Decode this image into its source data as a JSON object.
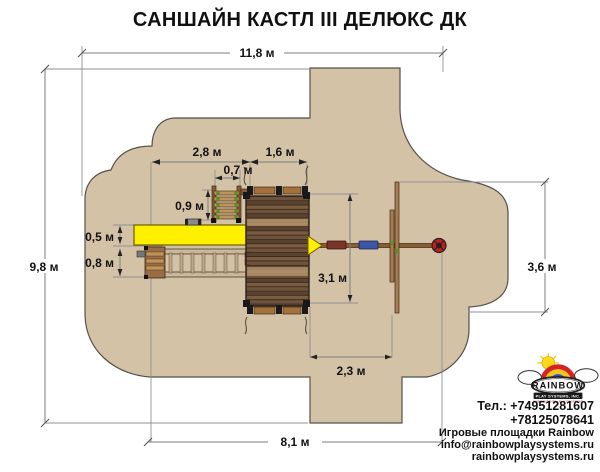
{
  "title": "САНШАЙН КАСТЛ III ДЕЛЮКС ДК",
  "dims": {
    "total_width": "11,8 м",
    "total_height": "9,8 м",
    "bottom_width": "8,1 м",
    "right_height": "3,6 м",
    "left_section": "2,8 м",
    "deck_width": "1,6 м",
    "climber_width": "0,7 м",
    "climber_depth": "0,9 м",
    "slide_depth": "0,5 м",
    "ramp_depth": "0,8 м",
    "deck_length": "3,1 м",
    "swing_span": "2,3 м"
  },
  "logo": {
    "brand": "RAINBOW",
    "subtitle": "PLAY SYSTEMS, INC.",
    "tagline": "FINE RESIDENTIAL PLAY EQUIPMENT"
  },
  "contact": {
    "phone_line1": "Тел.: +74951281607",
    "phone_line2": "+78125078641",
    "company": "Игровые площадки Rainbow",
    "email": "info@rainbowplaysystems.ru",
    "website": "rainbowplaysystems.ru"
  },
  "colors": {
    "safety_zone": "#d4c2a7",
    "slide_yellow": "#ffef00",
    "swing_seat_red": "#7c342b",
    "swing_seat_blue": "#3c57a6",
    "tire_red": "#c11f1f"
  }
}
